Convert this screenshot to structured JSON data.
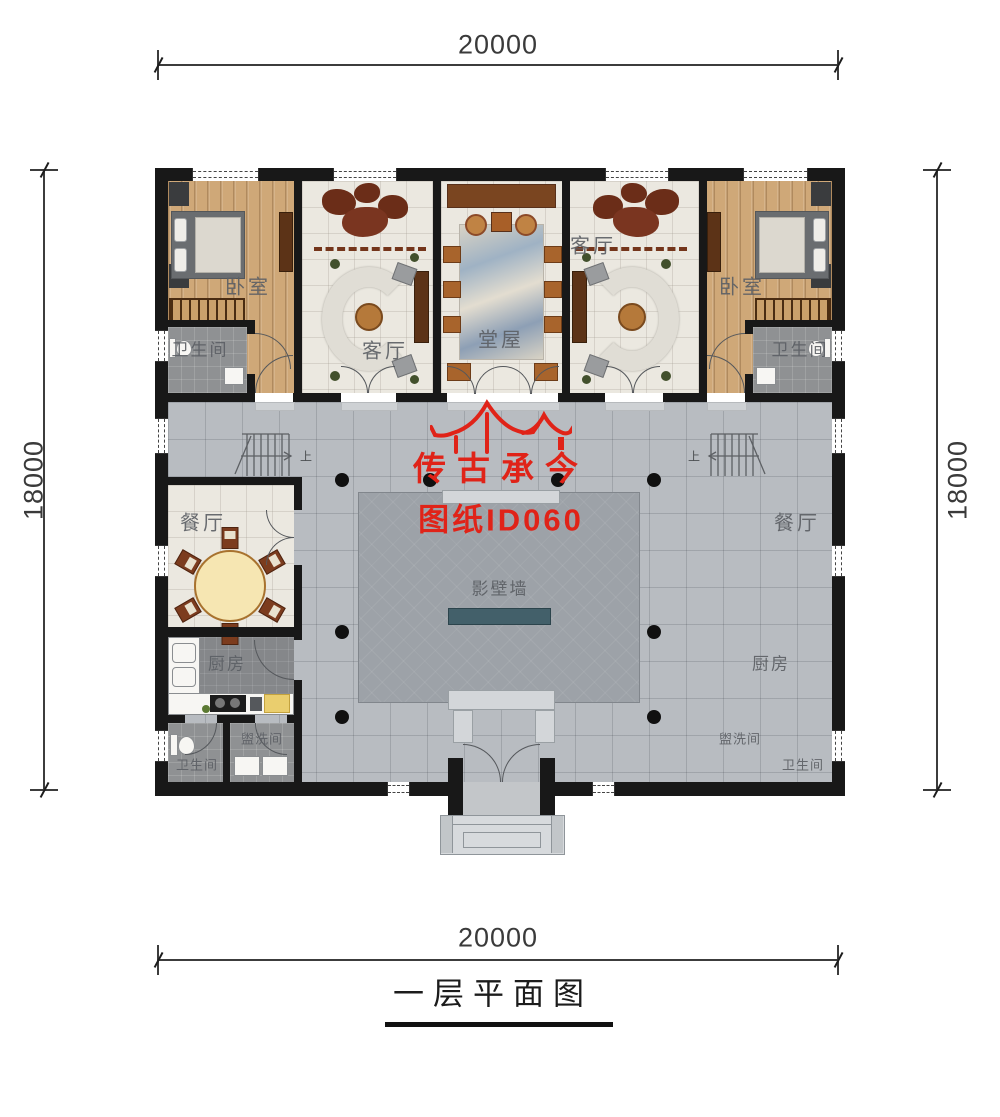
{
  "title": {
    "text": "一层平面图"
  },
  "dimensions": {
    "top": "20000",
    "bottom": "20000",
    "left": "18000",
    "right": "18000"
  },
  "watermark": {
    "brand": "传古承今",
    "sheet": "图纸ID060",
    "color": "#e02318"
  },
  "labels": {
    "bedroom_left": "卧室",
    "bedroom_right": "卧室",
    "living_left": "客厅",
    "living_right": "客厅",
    "hall": "堂屋",
    "bath_top_left": "卫生间",
    "bath_top_right": "卫生间",
    "dining_left": "餐厅",
    "dining_right": "餐厅",
    "kitchen_left": "厨房",
    "kitchen_right": "厨房",
    "wash_left": "盥洗间",
    "wash_right": "盥洗间",
    "bath_bottom_left": "卫生间",
    "bath_bottom_right": "卫生间",
    "screen_wall": "影壁墙",
    "stairs_up_left": "上",
    "stairs_up_right": "上"
  },
  "colors": {
    "wall": "#181818",
    "courtyard": "#b8bcc1",
    "court_center": "#9da2a8",
    "screen_wall": "#43606a",
    "wood_floor": "#cfa878",
    "tile_floor": "#ebe8e0",
    "accent_red": "#e02318"
  }
}
